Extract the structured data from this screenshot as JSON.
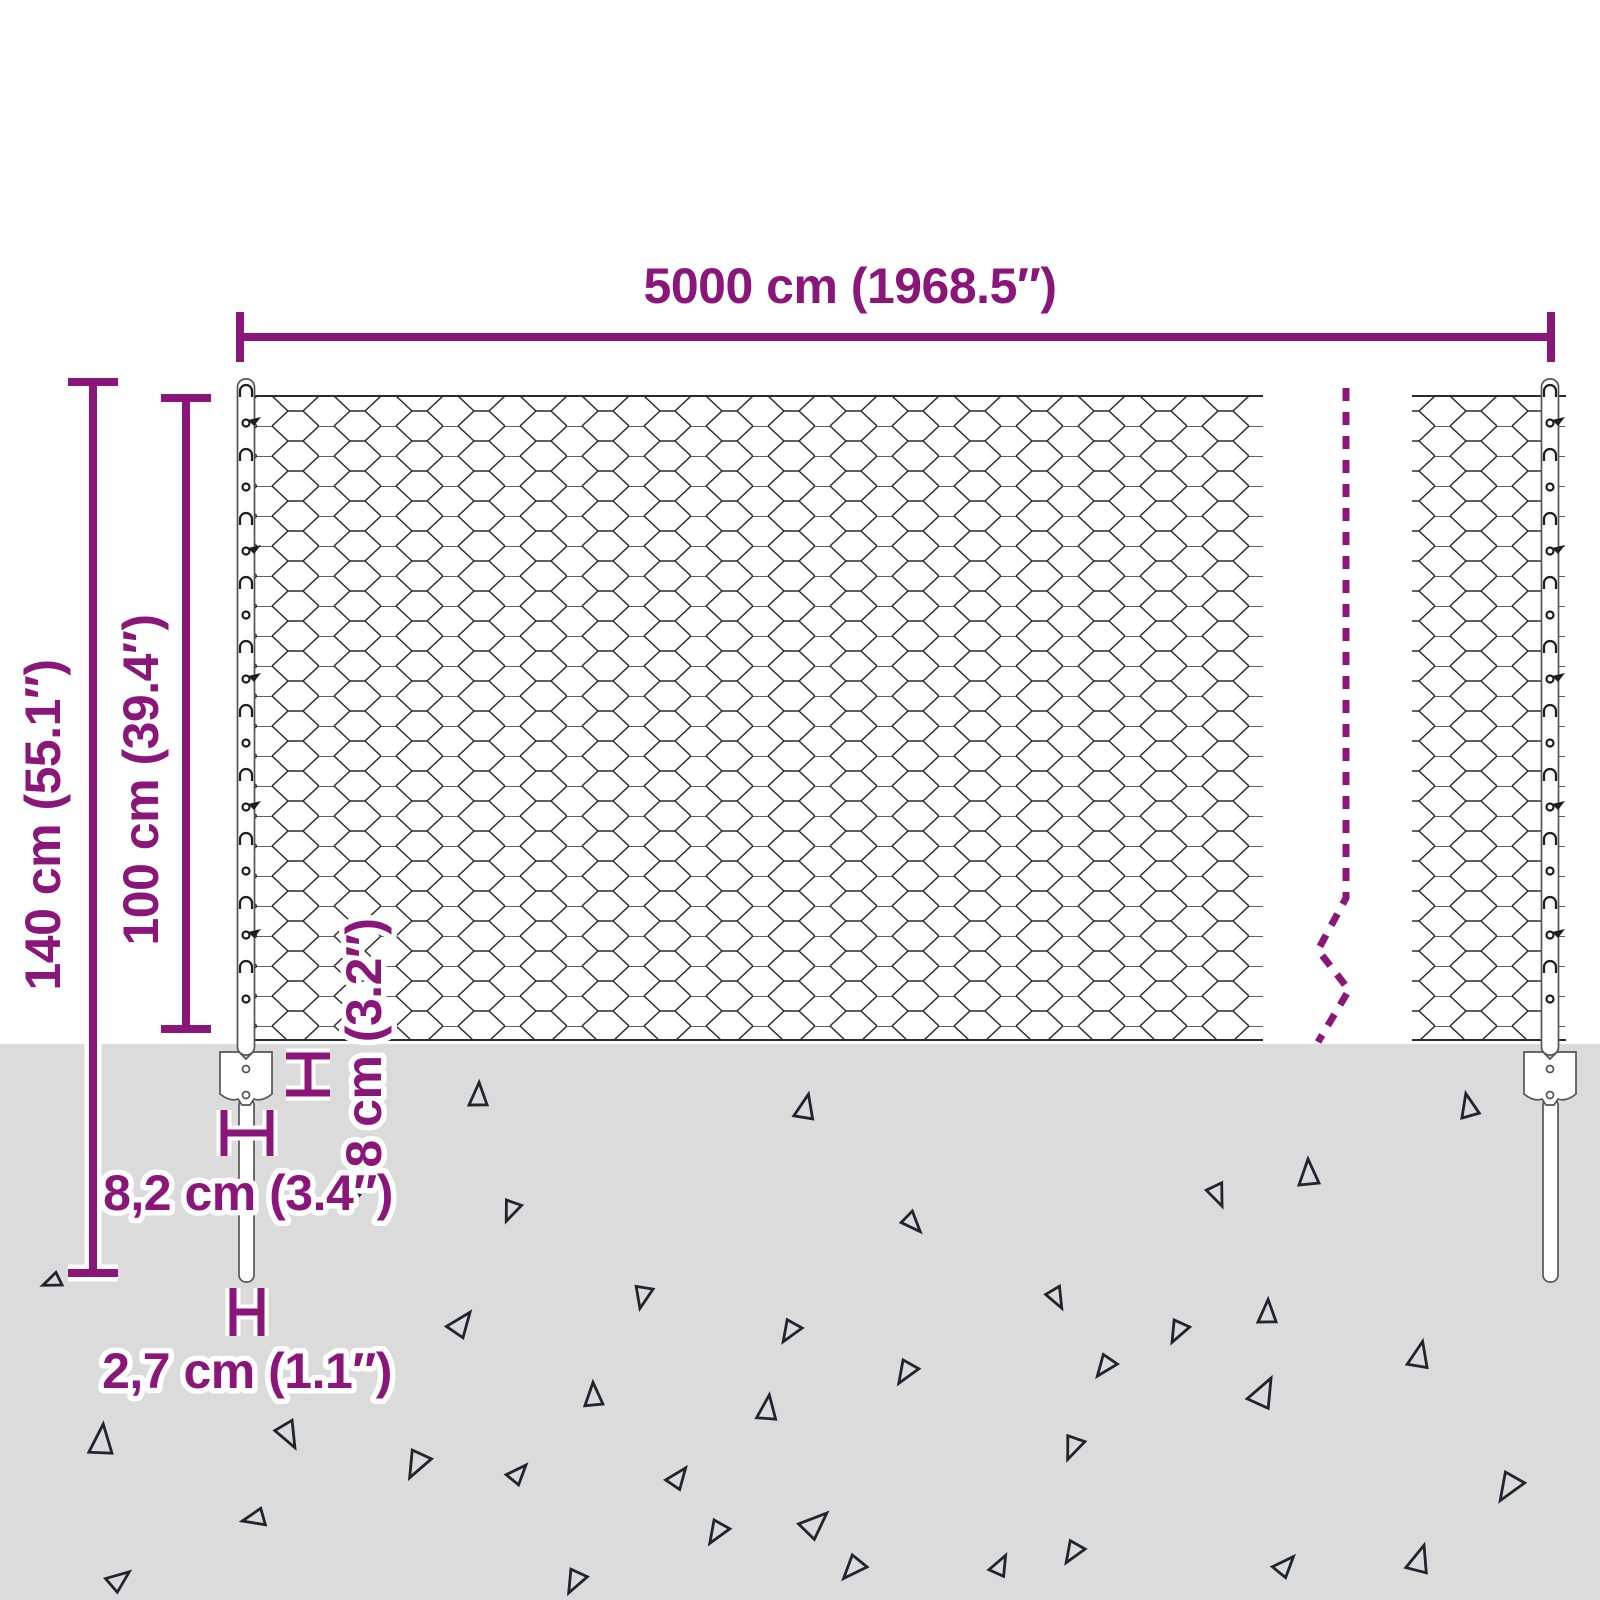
{
  "title": "Chain-link fence with posts and ground anchors - dimension diagram",
  "colors": {
    "accent": "#8A167A",
    "ground": "#DBDBDB",
    "mesh_line": "#2B2B2B",
    "post_outline": "#555555",
    "triangle": "#20242E"
  },
  "dimensions": {
    "total_width": "5000 cm (1968.5″)",
    "total_height": "140 cm (55.1″)",
    "fence_height": "100 cm (39.4″)",
    "anchor_offset": "8 cm (3.2″)",
    "anchor_plate_width": "8,2 cm (3.4″)",
    "post_width": "2,7 cm (1.1″)"
  },
  "decorations": {
    "ground_triangles": [
      {
        "x": 478,
        "y": 1095,
        "r": 5,
        "s": 0.9
      },
      {
        "x": 805,
        "y": 1107,
        "r": 15,
        "s": 0.95
      },
      {
        "x": 1468,
        "y": 1106,
        "r": -10,
        "s": 0.9
      },
      {
        "x": 1308,
        "y": 1173,
        "r": 0,
        "s": 1.0
      },
      {
        "x": 1218,
        "y": 1195,
        "r": 160,
        "s": 0.85
      },
      {
        "x": 511,
        "y": 1211,
        "r": 205,
        "s": 0.8
      },
      {
        "x": 352,
        "y": 1200,
        "r": 200,
        "s": 0.6
      },
      {
        "x": 913,
        "y": 1223,
        "r": 140,
        "s": 0.8
      },
      {
        "x": 52,
        "y": 1282,
        "r": 250,
        "s": 0.7
      },
      {
        "x": 643,
        "y": 1297,
        "r": 195,
        "s": 0.85
      },
      {
        "x": 1057,
        "y": 1298,
        "r": 155,
        "s": 0.8
      },
      {
        "x": 1267,
        "y": 1312,
        "r": 5,
        "s": 0.9
      },
      {
        "x": 461,
        "y": 1323,
        "r": 40,
        "s": 1.0
      },
      {
        "x": 790,
        "y": 1332,
        "r": 215,
        "s": 0.85
      },
      {
        "x": 1178,
        "y": 1332,
        "r": 210,
        "s": 0.85
      },
      {
        "x": 1419,
        "y": 1355,
        "r": 15,
        "s": 1.0
      },
      {
        "x": 1105,
        "y": 1367,
        "r": 220,
        "s": 0.85
      },
      {
        "x": 1263,
        "y": 1392,
        "r": 30,
        "s": 1.15
      },
      {
        "x": 593,
        "y": 1395,
        "r": 0,
        "s": 0.9
      },
      {
        "x": 767,
        "y": 1408,
        "r": 10,
        "s": 0.95
      },
      {
        "x": 289,
        "y": 1435,
        "r": 155,
        "s": 1.0
      },
      {
        "x": 101,
        "y": 1440,
        "r": 8,
        "s": 1.15
      },
      {
        "x": 417,
        "y": 1465,
        "r": 210,
        "s": 1.05
      },
      {
        "x": 518,
        "y": 1473,
        "r": 45,
        "s": 0.8
      },
      {
        "x": 678,
        "y": 1477,
        "r": 40,
        "s": 0.85
      },
      {
        "x": 906,
        "y": 1373,
        "r": 215,
        "s": 0.9
      },
      {
        "x": 717,
        "y": 1533,
        "r": 215,
        "s": 0.9
      },
      {
        "x": 815,
        "y": 1523,
        "r": 50,
        "s": 1.1
      },
      {
        "x": 1073,
        "y": 1448,
        "r": 205,
        "s": 0.9
      },
      {
        "x": 1509,
        "y": 1488,
        "r": 215,
        "s": 1.1
      },
      {
        "x": 254,
        "y": 1519,
        "r": 260,
        "s": 0.85
      },
      {
        "x": 119,
        "y": 1579,
        "r": 55,
        "s": 0.9
      },
      {
        "x": 575,
        "y": 1582,
        "r": 210,
        "s": 0.9
      },
      {
        "x": 1419,
        "y": 1559,
        "r": 20,
        "s": 1.05
      },
      {
        "x": 1285,
        "y": 1565,
        "r": 45,
        "s": 0.85
      },
      {
        "x": 1000,
        "y": 1565,
        "r": 30,
        "s": 0.8
      },
      {
        "x": 853,
        "y": 1569,
        "r": 225,
        "s": 0.95
      },
      {
        "x": 1073,
        "y": 1553,
        "r": 215,
        "s": 0.85
      }
    ]
  }
}
